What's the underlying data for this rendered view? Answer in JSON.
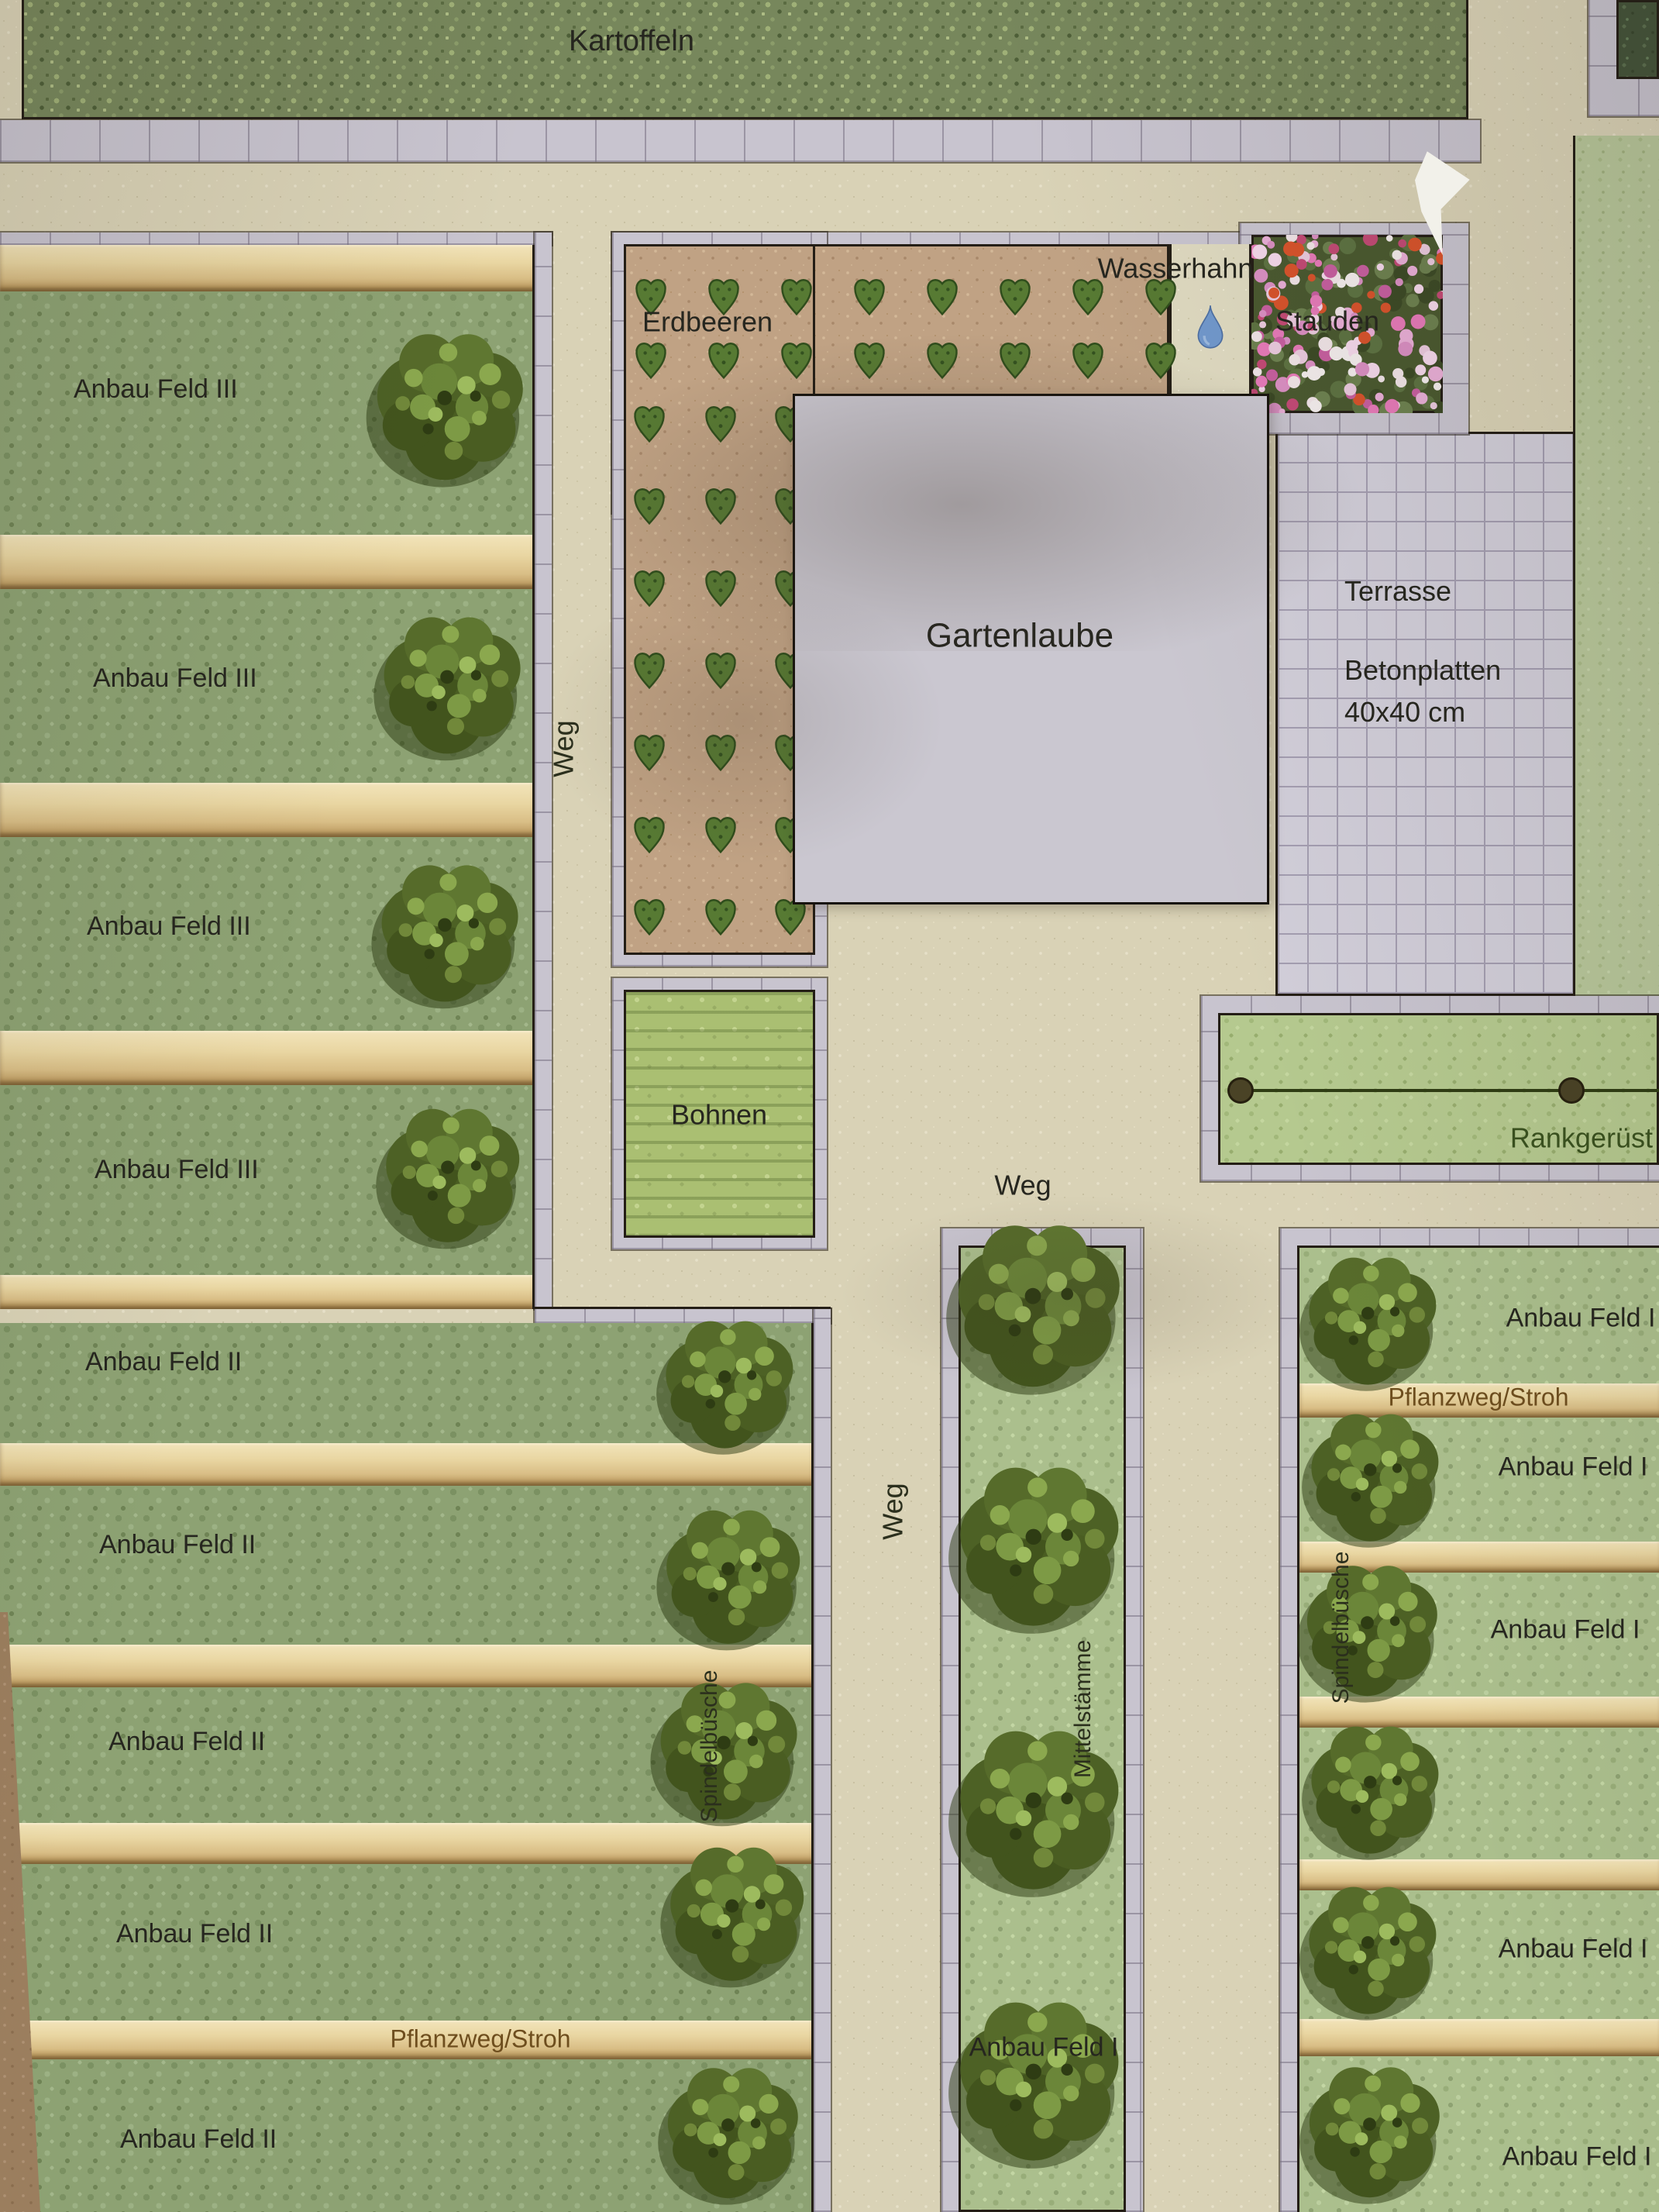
{
  "plan_labels": {
    "kartoffeln": "Kartoffeln",
    "erdbeeren": "Erdbeeren",
    "wasserhahn": "Wasserhahn",
    "stauden": "Stauden",
    "gartenlaube": "Gartenlaube",
    "terrasse_title": "Terrasse",
    "terrasse_material": "Betonplatten",
    "terrasse_size": "40x40 cm",
    "bohnen": "Bohnen",
    "rankgeruest": "Rankgerüst",
    "weg": "Weg",
    "pflanzweg_stroh": "Pflanzweg/Stroh",
    "spindelbuesche": "Spindelbüsche",
    "mittelstaemme": "Mittelstämme"
  },
  "left_block_rows": [
    {
      "label": "Anbau Feld III"
    },
    {
      "label": "Anbau Feld III"
    },
    {
      "label": "Anbau Feld III"
    },
    {
      "label": "Anbau Feld III"
    },
    {
      "label": "Anbau Feld II"
    },
    {
      "label": "Anbau Feld II"
    },
    {
      "label": "Anbau Feld II"
    },
    {
      "label": "Anbau Feld II"
    },
    {
      "label": "Anbau Feld II"
    }
  ],
  "middle_column": {
    "label": "Anbau Feld I"
  },
  "right_column_rows": [
    {
      "label": "Anbau Feld I"
    },
    {
      "label": "Anbau Feld I"
    },
    {
      "label": "Anbau Feld I"
    },
    {
      "label": ""
    },
    {
      "label": "Anbau Feld I"
    },
    {
      "label": "Anbau Feld I"
    }
  ],
  "icons": {
    "water_drop": "water-drop-icon",
    "bush": "bush-icon",
    "strawberry_plant": "strawberry-plant-icon",
    "trellis_post": "trellis-post-icon"
  },
  "colors": {
    "path": "#d9d2b6",
    "paver": "#c8c4cf",
    "field_dark": "#8da273",
    "field_light": "#abbf8d",
    "straw": "#e8d4a0",
    "soil": "#bfa184",
    "building": "#cac7d0",
    "terrace": "#d1ced9",
    "outline": "#241e16",
    "water_drop": "#7198cc",
    "bush": "#4d6125",
    "flower_pink": "#e8aed6",
    "flower_red": "#d7532c",
    "label_dark": "#26261f",
    "label_brown": "#6e4e1e",
    "label_green": "#3a521f"
  }
}
